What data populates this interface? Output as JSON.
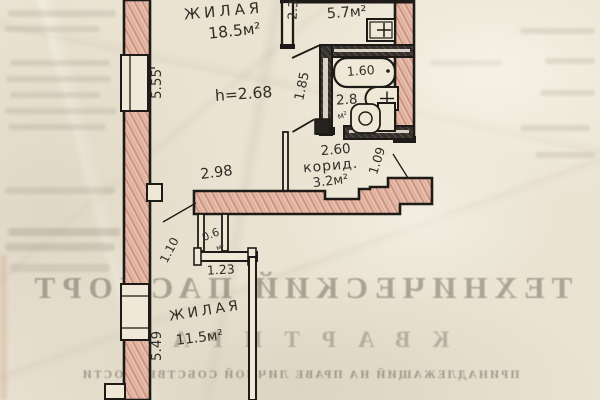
{
  "document_type": "scanned apartment floor plan (technical passport page, bleed-through watermark)",
  "texts": {
    "room1_name": "ЖИЛАЯ",
    "room1_area": "18.5м²",
    "ceiling_height": "h=2.68",
    "dim_left_top": "5.55",
    "dim_kitchen_width": "2.3",
    "kitchen_area": "5.7м²",
    "dim_hall": "1.85",
    "tub_length": "1.60",
    "bath_area": "2.8",
    "bath_area_unit": "м²",
    "corridor_width": "2.60",
    "corridor_name": "корид.",
    "corridor_area": "3.2м²",
    "dim_entry": "1.09",
    "dim_wall": "2.98",
    "dim_doorway": "1.10",
    "closet_area": "0.6",
    "closet_area_unit": "м²",
    "dim_niche": "1.23",
    "room2_name": "ЖИЛАЯ",
    "room2_area": "11.5м²",
    "dim_left_bottom": "5.49"
  },
  "watermark": {
    "title": "ТЕХНИЧЕСКИЙ ПАСПОРТ",
    "line2": "КВАРТИРА",
    "line3": "ПРИНАДЛЕЖАЩИЙ НА ПРАВЕ ЛИЧНОЙ СОБСТВЕННОСТИ"
  },
  "colors": {
    "paper": "#eae3d2",
    "wall_pink": "#e6c0ae",
    "wall_pink_hatch": "#cf9480",
    "dark_wall": "#33302b",
    "ink": "#1d1a17"
  }
}
